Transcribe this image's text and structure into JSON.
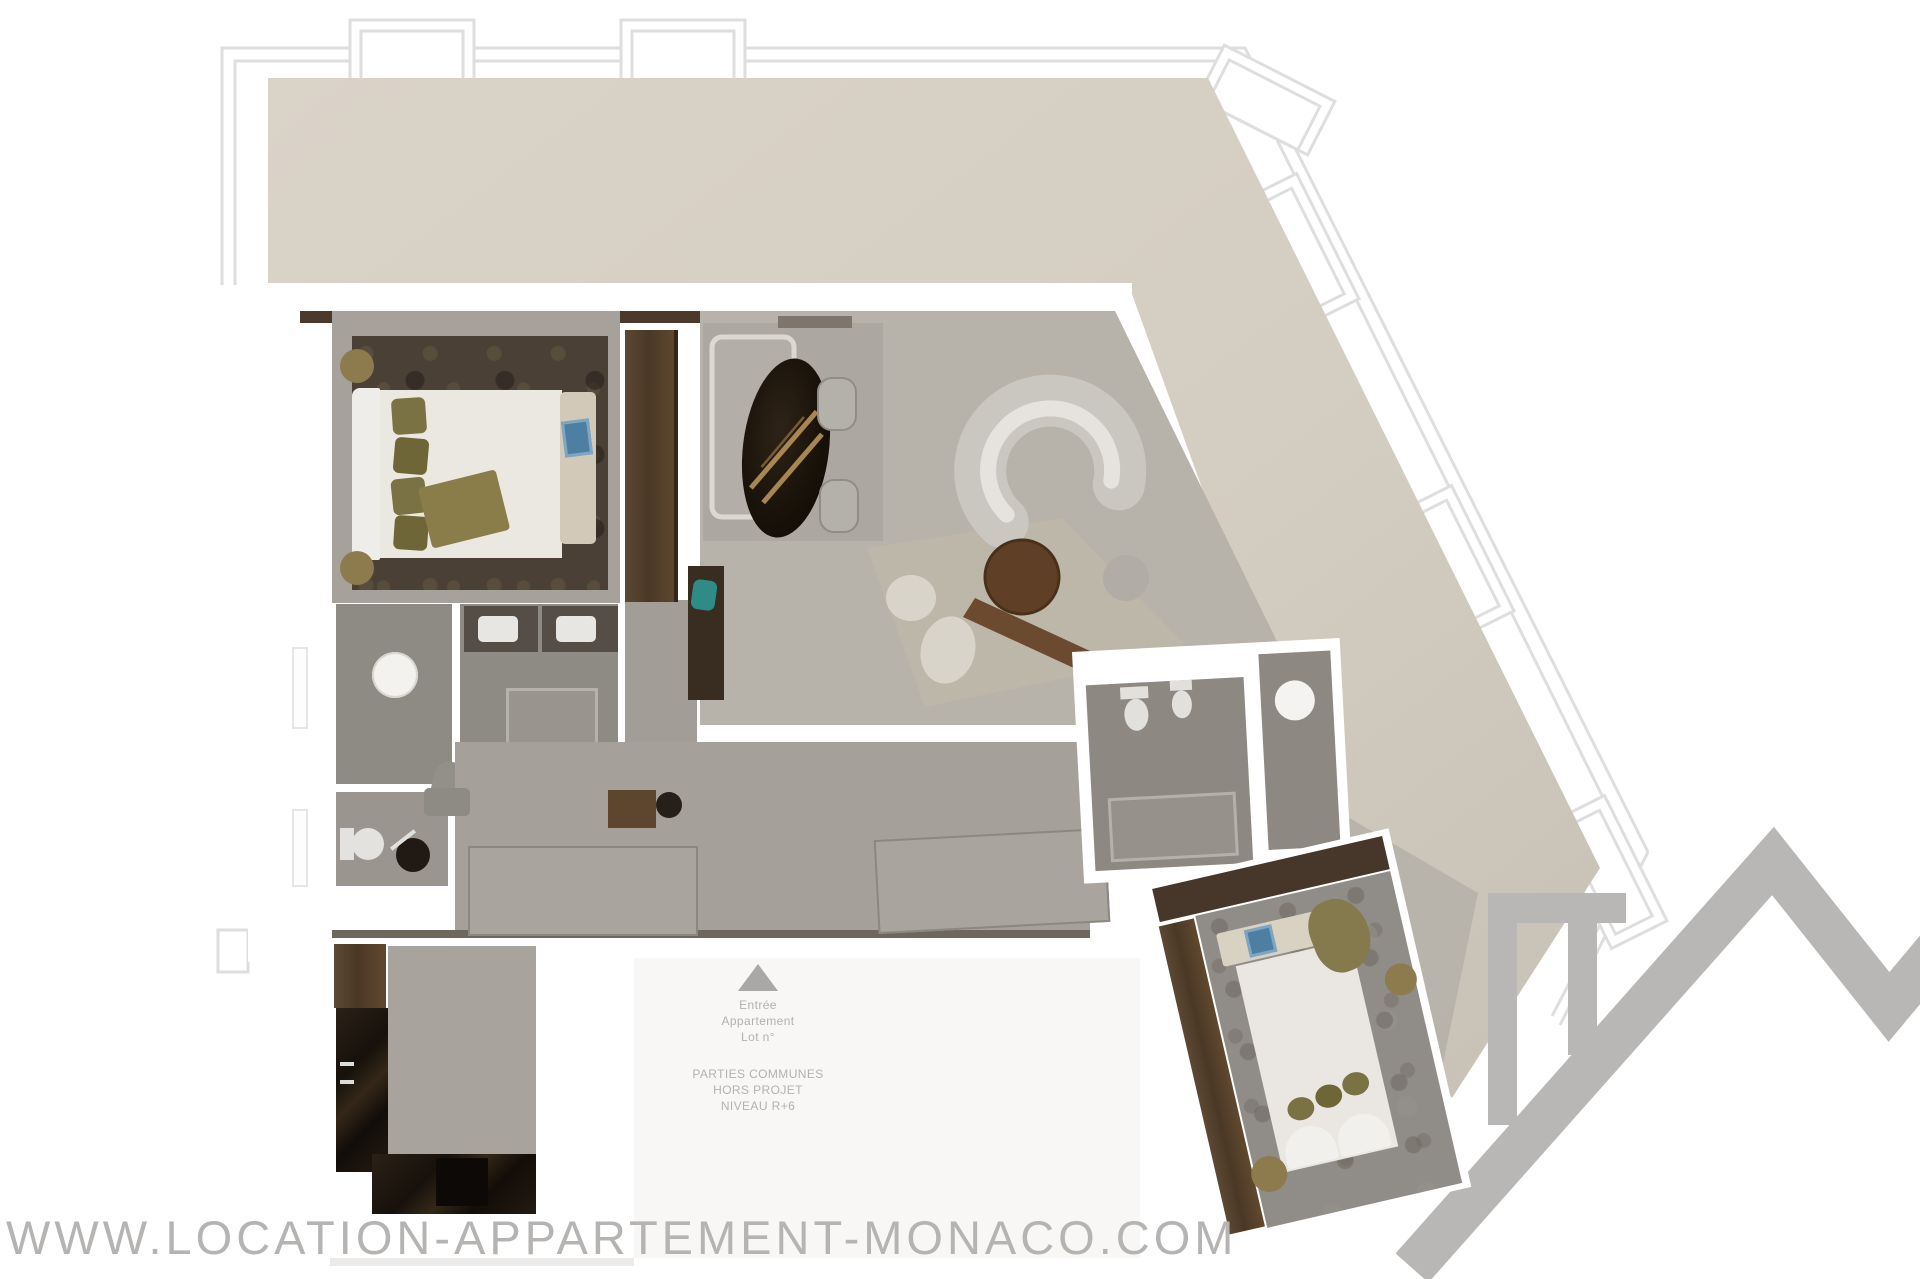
{
  "watermark": {
    "text": "WWW.LOCATION-APPARTEMENT-MONACO.COM",
    "color": "#b6b4b2"
  },
  "entry": {
    "arrow_icon": "up-triangle-icon",
    "lines": [
      "Entrée",
      "Appartement",
      "Lot n°"
    ]
  },
  "common_area": {
    "lines": [
      "PARTIES COMMUNES",
      "HORS PROJET",
      "NIVEAU R+6"
    ]
  },
  "logo": {
    "icon": "roofline-house-logo",
    "color": "#b9b7b5"
  },
  "colors": {
    "terrace": "#d7d0c5",
    "room_floor": "#a6a19a",
    "living_floor": "#b7b2aa",
    "bath_floor": "#8d8982",
    "wall": "#ffffff",
    "dark_wood": "#4b3a2b",
    "marble": "#221912",
    "outline": "#dedede",
    "accent_blue": "#4d7fa3",
    "accent_teal": "#2f8b86",
    "olive_pillow": "#7b7243",
    "gold_pouf": "#8d7b4e"
  }
}
